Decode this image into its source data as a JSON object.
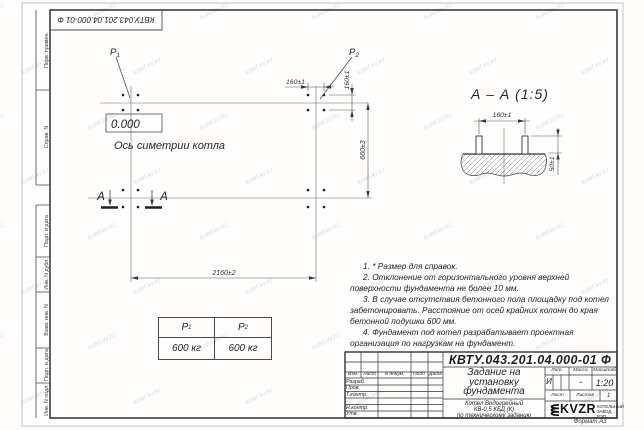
{
  "watermark": {
    "text": "kotel-kv.kz"
  },
  "frame": {
    "stamp_number": "КВТУ.043.201.04.000-01 Ф",
    "columns": [
      "Перв. примен.",
      "Справ. N",
      "Подп. и дата",
      "Инв. N дубл.",
      "Взам. инв. N",
      "Подп. и дата",
      "Инв. N подл."
    ],
    "format_label": "Формат А3"
  },
  "plan": {
    "p1": {
      "name": "P",
      "sub": "1"
    },
    "p2": {
      "name": "P",
      "sub": "2"
    },
    "elevation": "0.000",
    "axis_label": "Ось симетрии котла",
    "section_letter_1": "А",
    "section_letter_2": "А",
    "dim_bolt_spacing_h": "160±1",
    "dim_bolt_spacing_v": "160±1",
    "dim_groups_v": "660±3",
    "dim_groups_h": "2160±2"
  },
  "section": {
    "title": "А – А (1:5)",
    "dim_bolt_spacing": "160±1",
    "dim_bolt_height": "50±1"
  },
  "load_table": {
    "col1": {
      "name": "P",
      "sub": "1",
      "value": "600 кг"
    },
    "col2": {
      "name": "P",
      "sub": "2",
      "value": "600 кг"
    }
  },
  "notes": [
    "1. * Размер для справок.",
    "2. Отклонение от горизонтального уровня верхней поверхности фундамента не более 10 мм.",
    "3. В случае отсутствия бетонного пола площадку под котел забетонировать. Расстояние от осей крайних колонн до края бетонной подушки 600 мм.",
    "4. Фундамент под котел разрабатывает проектная организация по нагрузкам на фундамент."
  ],
  "title_block": {
    "doc_number": "КВТУ.043.201.04.000-01 Ф",
    "title_lines": [
      "Задание на",
      "установку",
      "фундамента"
    ],
    "subtitle_lines": [
      "Котел Водогрейный",
      "КВ-0,5 КБД (К)",
      "по техническому заданию"
    ],
    "change_header": {
      "izm": "Изм.",
      "list": "Лист",
      "doc": "N докум.",
      "podp": "Подп.",
      "data": "Дата"
    },
    "sign_rows": [
      "Разраб.",
      "Пров.",
      "Т.контр.",
      "",
      "Н.контр.",
      "Утв."
    ],
    "lit_label": "Лит.",
    "mass_label": "Масса",
    "scale_label": "Масштаб",
    "lit_value": "И",
    "mass_value": "-",
    "scale_value": "1:20",
    "sheet_label": "Лист",
    "sheets_label": "Листов",
    "sheets_value": "1",
    "logo_text": "KVZR",
    "org_line1": "КОТЕЛЬНЫЙ",
    "org_line2": "ЗАВОД РЭП"
  }
}
